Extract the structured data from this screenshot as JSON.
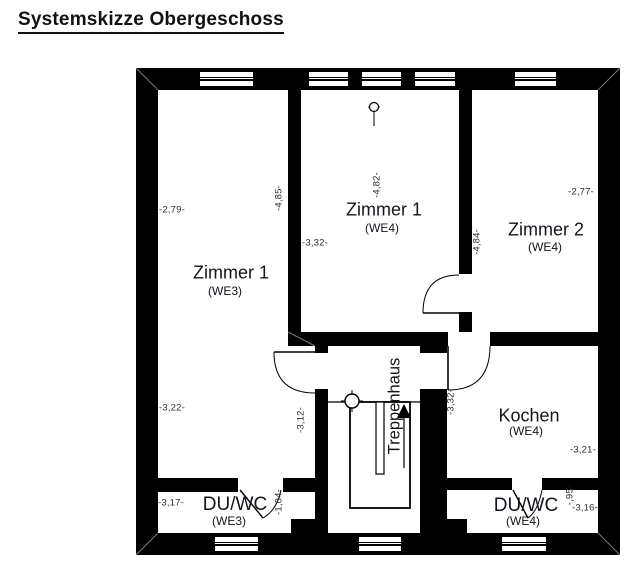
{
  "title": "Systemskizze Obergeschoss",
  "plan": {
    "rooms": {
      "zimmer1_we3": {
        "name": "Zimmer 1",
        "unit": "(WE3)"
      },
      "zimmer1_we4": {
        "name": "Zimmer 1",
        "unit": "(WE4)"
      },
      "zimmer2_we4": {
        "name": "Zimmer 2",
        "unit": "(WE4)"
      },
      "kochen_we4": {
        "name": "Kochen",
        "unit": "(WE4)"
      },
      "duwc_we3": {
        "name": "DU/WC",
        "unit": "(WE3)"
      },
      "duwc_we4": {
        "name": "DU/WC",
        "unit": "(WE4)"
      },
      "treppenhaus": {
        "name": "Treppenhaus"
      }
    },
    "dimensions": {
      "zimmer1_we3_width_top": "-2,79-",
      "zimmer1_we3_height": "-4,85-",
      "zimmer1_we4_height": "-4,82-",
      "zimmer1_we4_width": "-3,32-",
      "zimmer2_we4_height": "-4,84-",
      "zimmer2_we4_width": "-2,77-",
      "zimmer1_we3_width_bottom": "-3,22-",
      "zimmer1_we3_lower_height": "-3,12-",
      "duwc_we3_width": "-3,17-",
      "duwc_we3_height": "-1,04-",
      "hall_we4_height": "-3,32-",
      "kochen_width": "-3,21-",
      "duwc_we4_width": "-3,16-",
      "duwc_we4_height": "-,95-"
    },
    "colors": {
      "wall": "#000000",
      "text": "#1c1c1c"
    }
  }
}
